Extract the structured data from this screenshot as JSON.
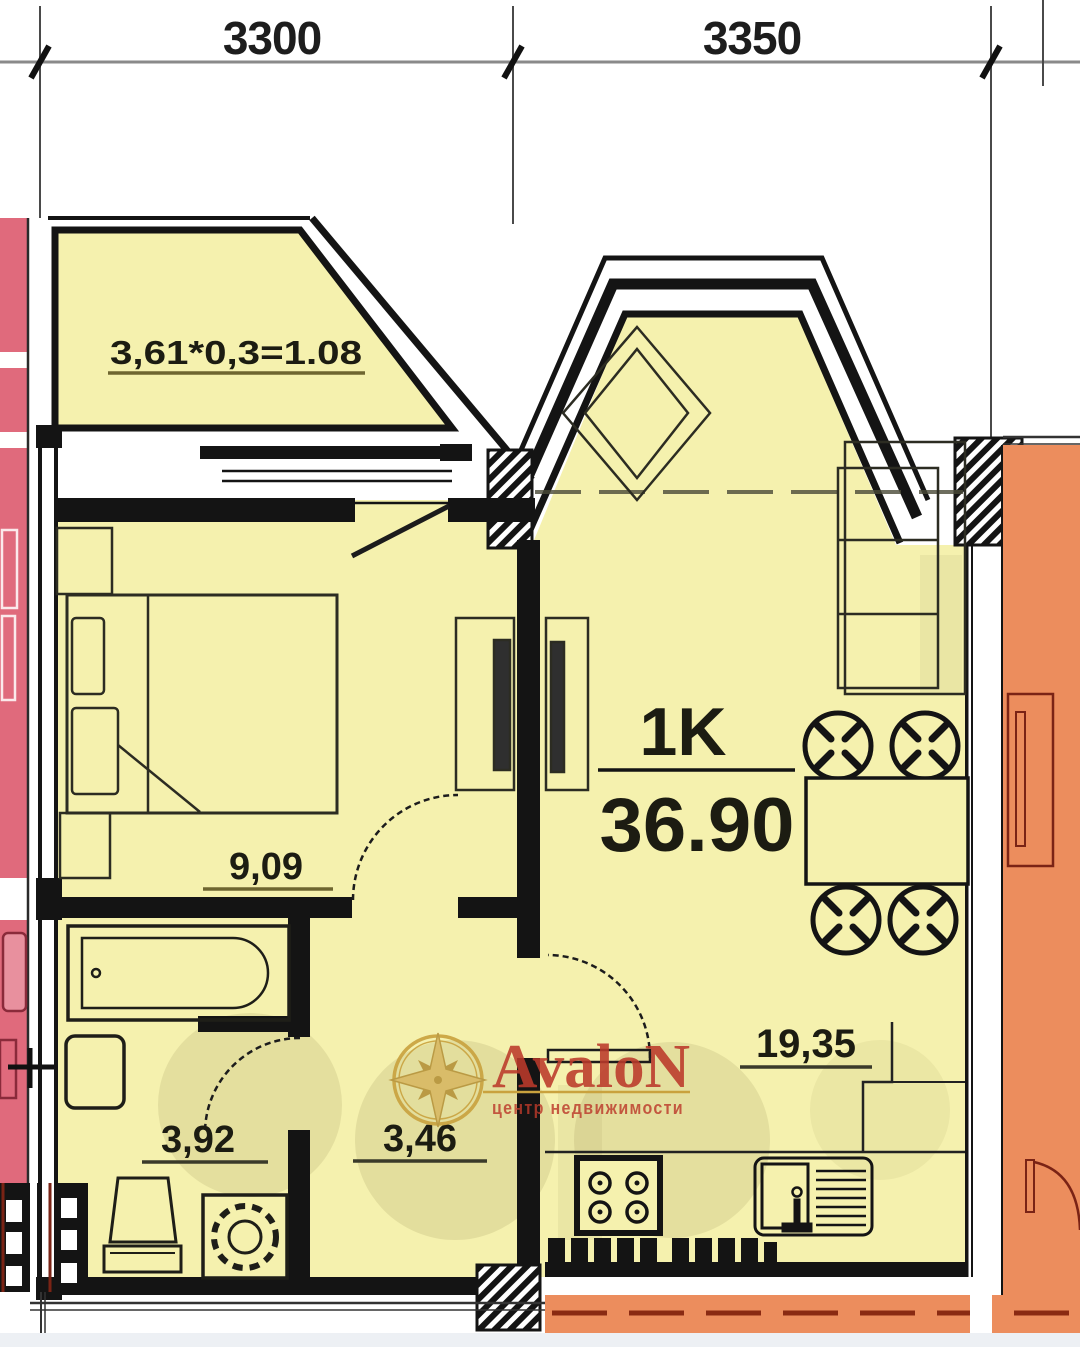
{
  "dimension_labels": {
    "left": "3300",
    "right": "3350"
  },
  "balcony": {
    "area_formula": "3,61*0,3=1.08"
  },
  "rooms": {
    "bedroom_area": "9,09",
    "bathroom_area": "3,92",
    "hallway_area": "3,46",
    "kitchen_living_area": "19,35",
    "unit_type": "1K",
    "total_area": "36.90"
  },
  "watermark": {
    "brand": "AvaloN",
    "tagline": "центр недвижимости"
  },
  "palette": {
    "unit_fill": "#f5f1ae",
    "adjacent_left_fill": "#e06a7c",
    "adjacent_right_fill": "#ec8d5d",
    "adjacent_right_lines": "#7a2315",
    "wall": "#141414",
    "label_underline": "#6e6630",
    "watermark_red": "#bc3a2b",
    "watermark_gold": "#c9a23e",
    "bottom_strip": "#edf0f4"
  }
}
